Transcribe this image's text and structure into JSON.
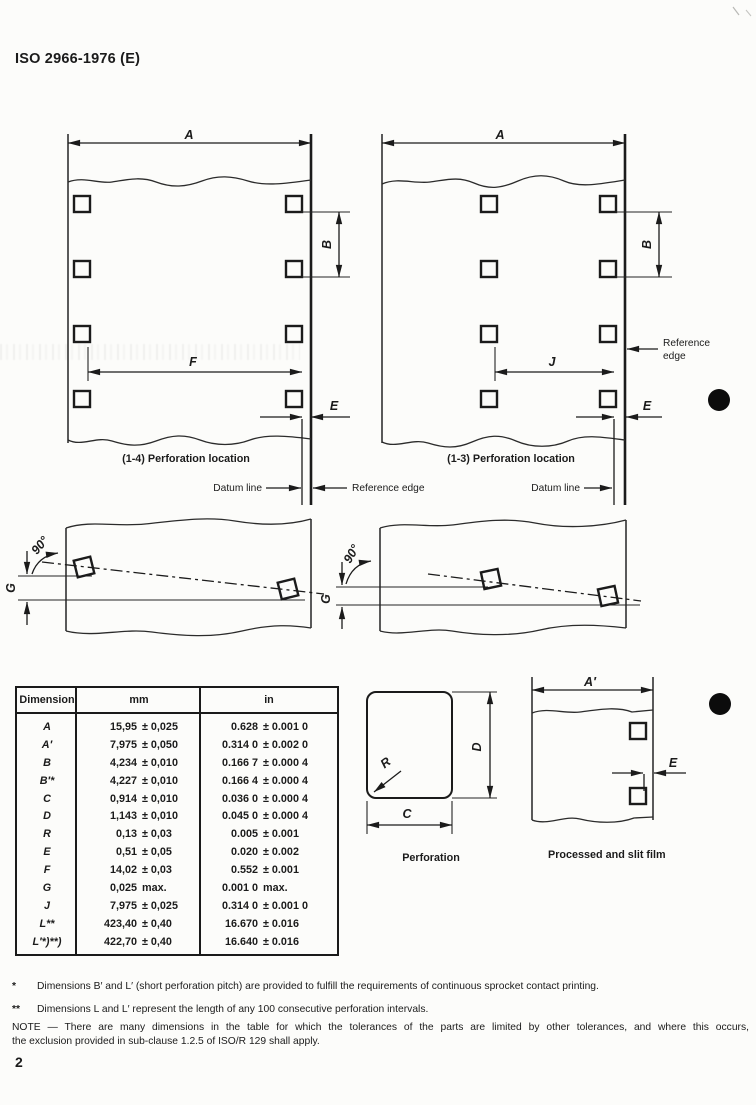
{
  "header": {
    "doc_number": "ISO 2966-1976 (E)"
  },
  "page_number": "2",
  "diagrams": {
    "dims": {
      "A": "A",
      "A_prime": "A′",
      "B": "B",
      "C": "C",
      "D": "D",
      "E": "E",
      "F": "F",
      "G": "G",
      "J": "J",
      "R": "R",
      "angle": "90°"
    },
    "left_film": {
      "caption": "(1-4) Perforation location"
    },
    "right_film": {
      "caption": "(1-3) Perforation location"
    },
    "labels": {
      "datum_line": "Datum line",
      "reference_edge": "Reference edge",
      "reference_word": "Reference",
      "edge_word": "edge"
    },
    "perforation_detail": {
      "caption": "Perforation"
    },
    "slit_film": {
      "caption": "Processed and slit film"
    }
  },
  "table": {
    "headers": [
      "Dimension",
      "mm",
      "in"
    ],
    "rows": [
      {
        "dim": "A",
        "mm_v": "15,95",
        "mm_t": "± 0,025",
        "in_v": "0.628",
        "in_t": "± 0.001 0"
      },
      {
        "dim": "A′",
        "mm_v": "7,975",
        "mm_t": "± 0,050",
        "in_v": "0.314 0",
        "in_t": "± 0.002 0"
      },
      {
        "dim": "B",
        "mm_v": "4,234",
        "mm_t": "± 0,010",
        "in_v": "0.166 7",
        "in_t": "± 0.000 4"
      },
      {
        "dim": "B′*",
        "mm_v": "4,227",
        "mm_t": "± 0,010",
        "in_v": "0.166 4",
        "in_t": "± 0.000 4"
      },
      {
        "dim": "C",
        "mm_v": "0,914",
        "mm_t": "± 0,010",
        "in_v": "0.036 0",
        "in_t": "± 0.000 4"
      },
      {
        "dim": "D",
        "mm_v": "1,143",
        "mm_t": "± 0,010",
        "in_v": "0.045 0",
        "in_t": "± 0.000 4"
      },
      {
        "dim": "R",
        "mm_v": "0,13",
        "mm_t": "± 0,03",
        "in_v": "0.005",
        "in_t": "± 0.001"
      },
      {
        "dim": "E",
        "mm_v": "0,51",
        "mm_t": "± 0,05",
        "in_v": "0.020",
        "in_t": "± 0.002"
      },
      {
        "dim": "F",
        "mm_v": "14,02",
        "mm_t": "± 0,03",
        "in_v": "0.552",
        "in_t": "± 0.001"
      },
      {
        "dim": "G",
        "mm_v": "0,025",
        "mm_t": "max.",
        "in_v": "0.001 0",
        "in_t": "max."
      },
      {
        "dim": "J",
        "mm_v": "7,975",
        "mm_t": "± 0,025",
        "in_v": "0.314 0",
        "in_t": "± 0.001 0"
      },
      {
        "dim": "L**",
        "mm_v": "423,40",
        "mm_t": "± 0,40",
        "in_v": "16.670",
        "in_t": "± 0.016"
      },
      {
        "dim": "L′*)**)",
        "mm_v": "422,70",
        "mm_t": "± 0,40",
        "in_v": "16.640",
        "in_t": "± 0.016"
      }
    ]
  },
  "footnotes": {
    "fn1_symbol": "*",
    "fn1_text": "Dimensions B′ and L′ (short perforation pitch) are provided to fulfill the requirements of continuous sprocket contact printing.",
    "fn2_symbol": "**",
    "fn2_text": "Dimensions L and L′ represent the length of any 100 consecutive perforation intervals.",
    "note_line1": "NOTE — There are many dimensions in the table for which the tolerances of the parts are limited by other tolerances, and where this occurs,",
    "note_line2": "the exclusion provided in sub-clause 1.2.5 of ISO/R 129 shall apply."
  }
}
